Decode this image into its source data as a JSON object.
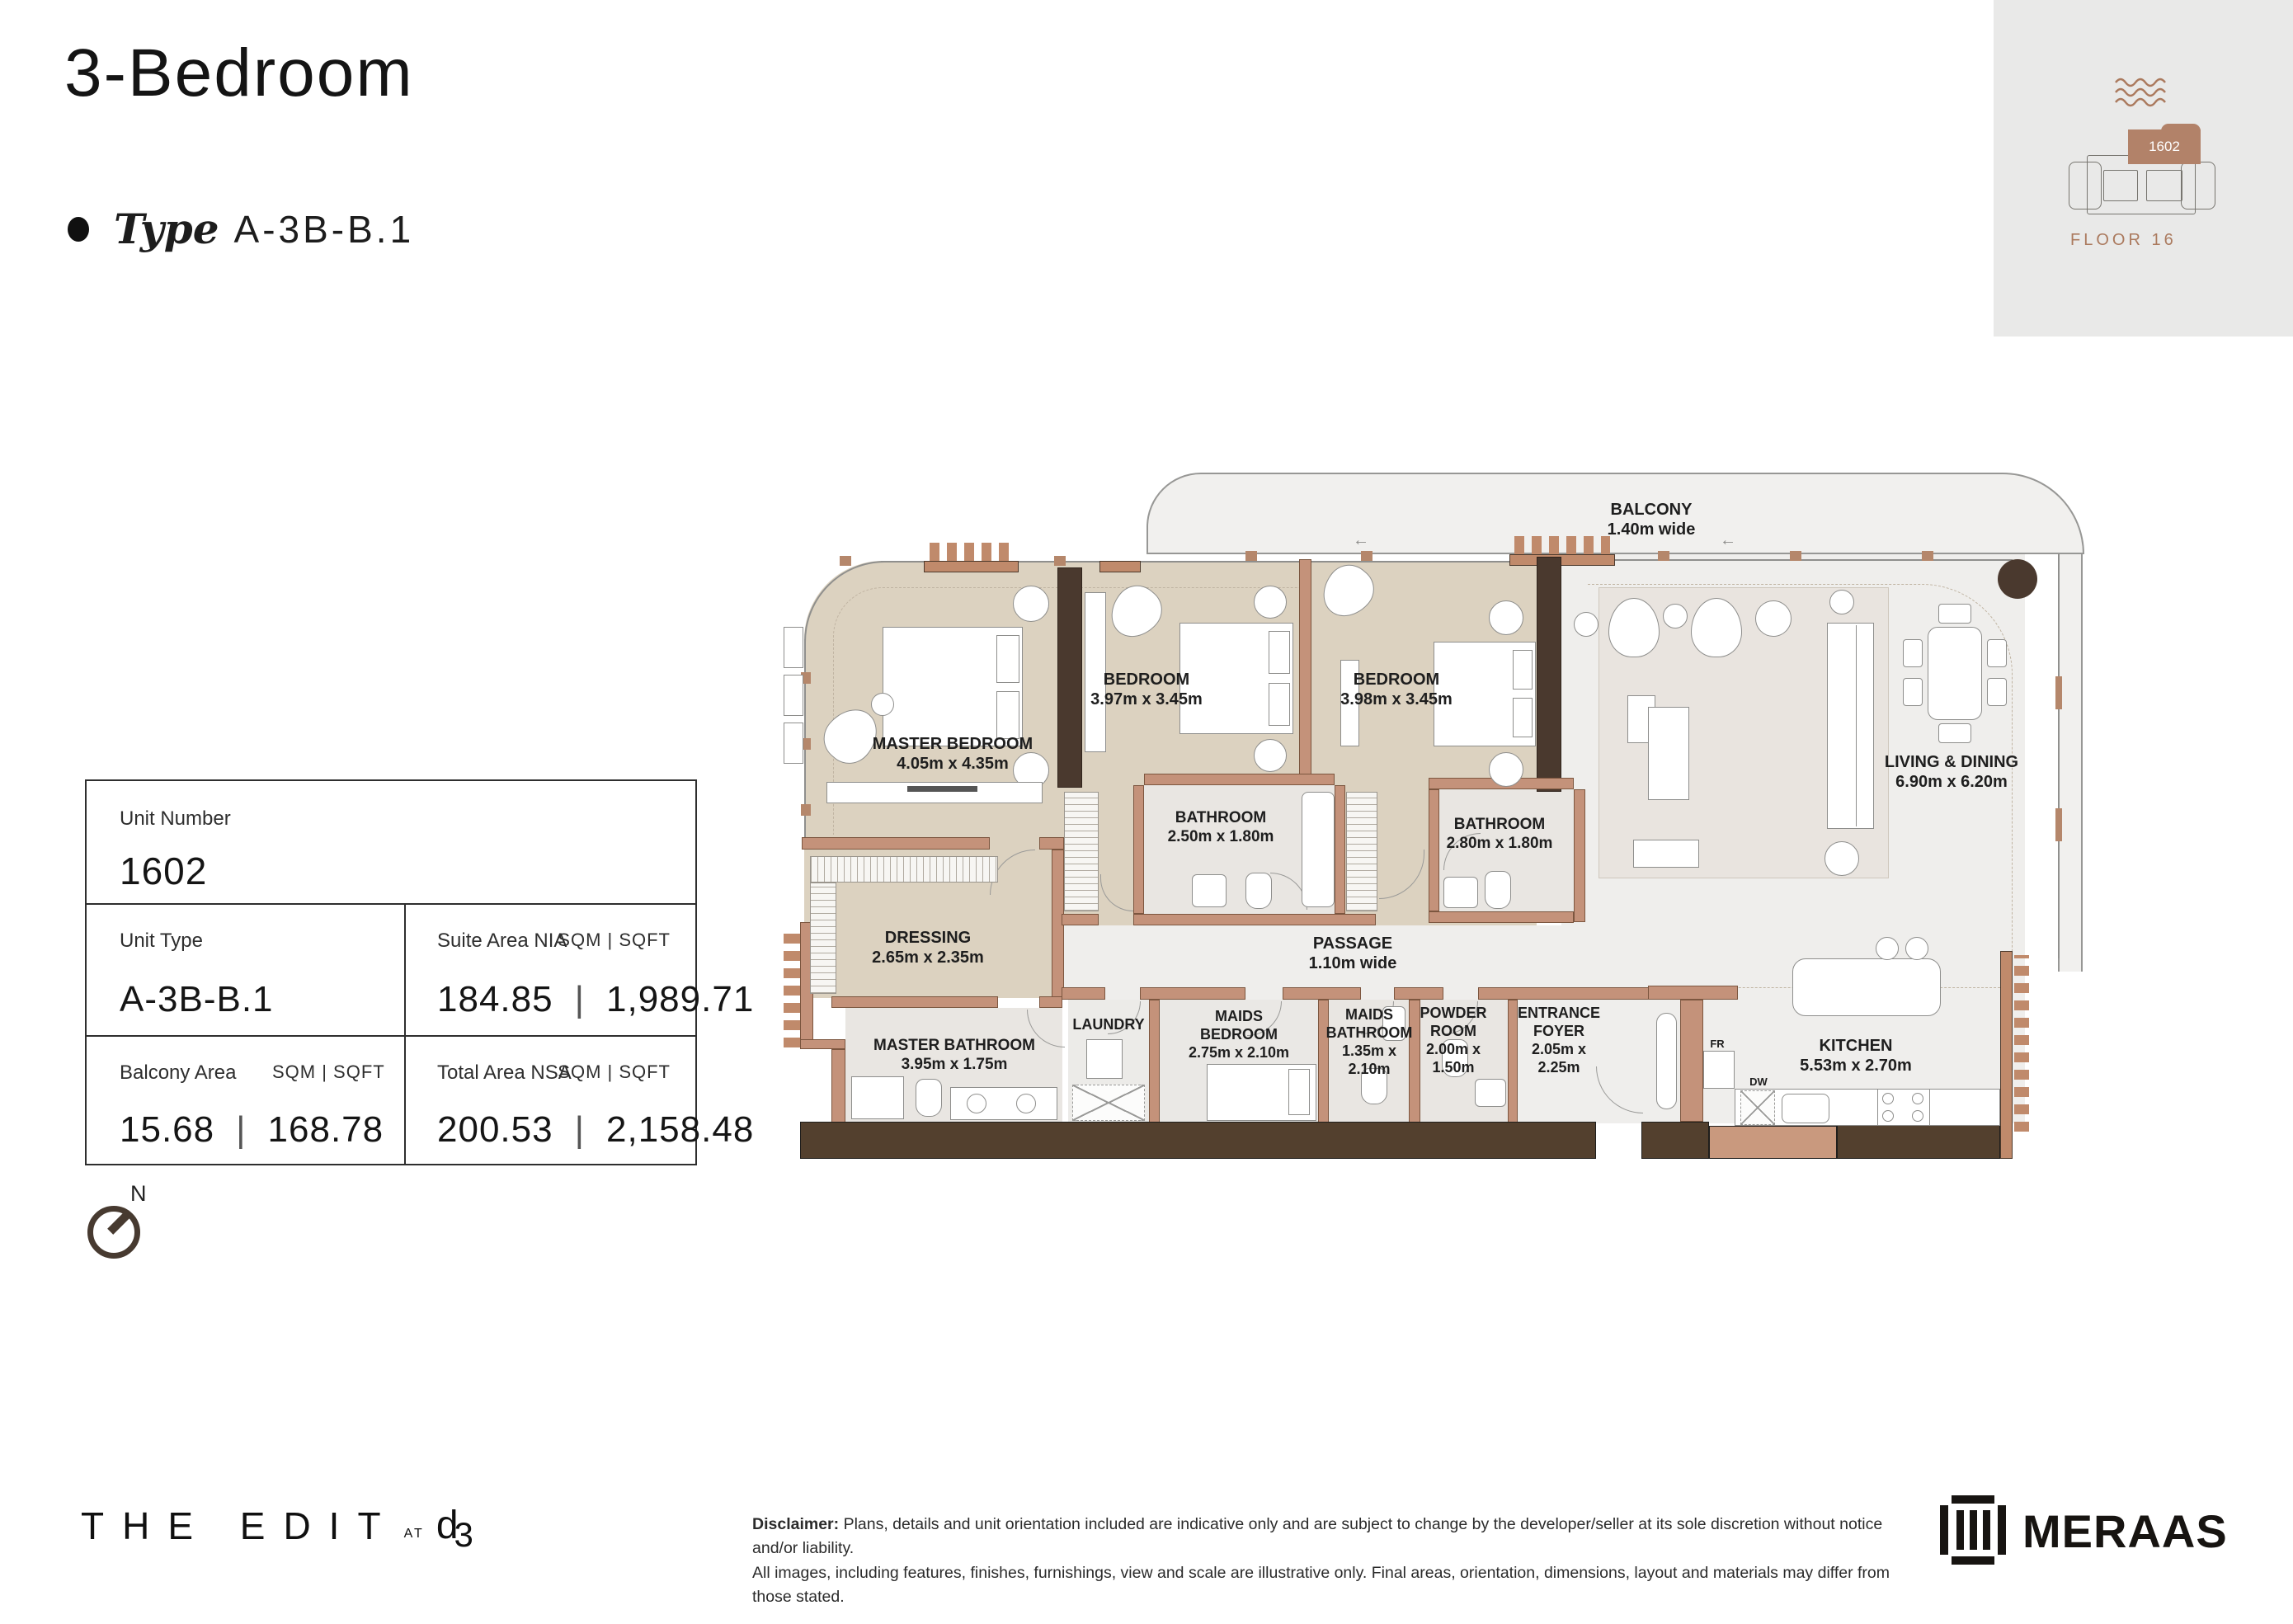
{
  "header": {
    "title": "3-Bedroom",
    "type_label": "Type",
    "type_value": "A-3B-B.1"
  },
  "locator": {
    "unit": "1602",
    "floor": "FLOOR 16"
  },
  "info_table": {
    "unit_number_label": "Unit Number",
    "unit_number": "1602",
    "unit_type_label": "Unit Type",
    "unit_type": "A-3B-B.1",
    "suite_label": "Suite Area NIA",
    "suite_units": "SQM | SQFT",
    "suite_sqm": "184.85",
    "suite_sep": "|",
    "suite_sqft": "1,989.71",
    "balcony_label": "Balcony Area",
    "balcony_units": "SQM | SQFT",
    "balcony_sqm": "15.68",
    "balcony_sep": "|",
    "balcony_sqft": "168.78",
    "total_label": "Total Area NSA",
    "total_units": "SQM | SQFT",
    "total_sqm": "200.53",
    "total_sep": "|",
    "total_sqft": "2,158.48"
  },
  "compass": {
    "north": "N"
  },
  "floorplan": {
    "rooms": {
      "balcony": {
        "name": "BALCONY",
        "dim": "1.40m wide"
      },
      "master_bedroom": {
        "name": "MASTER BEDROOM",
        "dim": "4.05m x 4.35m"
      },
      "bedroom1": {
        "name": "BEDROOM",
        "dim": "3.97m x 3.45m"
      },
      "bedroom2": {
        "name": "BEDROOM",
        "dim": "3.98m x 3.45m"
      },
      "bathroom1": {
        "name": "BATHROOM",
        "dim": "2.50m x 1.80m"
      },
      "bathroom2": {
        "name": "BATHROOM",
        "dim": "2.80m x 1.80m"
      },
      "dressing": {
        "name": "DRESSING",
        "dim": "2.65m x 2.35m"
      },
      "master_bathroom": {
        "name": "MASTER BATHROOM",
        "dim": "3.95m x 1.75m"
      },
      "passage": {
        "name": "PASSAGE",
        "dim": "1.10m wide"
      },
      "laundry": {
        "name": "LAUNDRY",
        "dim": ""
      },
      "maids_bedroom": {
        "name": "MAIDS BEDROOM",
        "dim": "2.75m x 2.10m"
      },
      "maids_bathroom": {
        "name": "MAIDS BATHROOM",
        "dim": "1.35m x 2.10m"
      },
      "powder_room": {
        "name": "POWDER ROOM",
        "dim": "2.00m x 1.50m"
      },
      "entrance_foyer": {
        "name": "ENTRANCE FOYER",
        "dim": "2.05m x 2.25m"
      },
      "living_dining": {
        "name": "LIVING & DINING",
        "dim": "6.90m x 6.20m"
      },
      "kitchen": {
        "name": "KITCHEN",
        "dim": "5.53m x 2.70m"
      }
    },
    "appliances": {
      "fridge": "FR",
      "dishwasher": "DW"
    },
    "icons": {
      "arrow_left": "←"
    }
  },
  "footer": {
    "brand_main": "THE EDIT",
    "brand_at": "AT",
    "brand_d": "d",
    "brand_3": "3",
    "disclaimer_bold": "Disclaimer:",
    "disclaimer_line1": "Plans, details and unit orientation included are indicative only and are subject to change by the developer/seller at its sole discretion without notice and/or liability.",
    "disclaimer_line2": "All images, including features, finishes, furnishings, view and scale are illustrative only. Final areas, orientation, dimensions, layout and materials may differ from those stated.",
    "developer": "MERAAS"
  },
  "colors": {
    "wall": "#c4927a",
    "dark_wall": "#4a392e",
    "beige_floor": "#dcd2c0",
    "brand_brown": "#b28269",
    "locator_bg": "#e9e9e8"
  }
}
